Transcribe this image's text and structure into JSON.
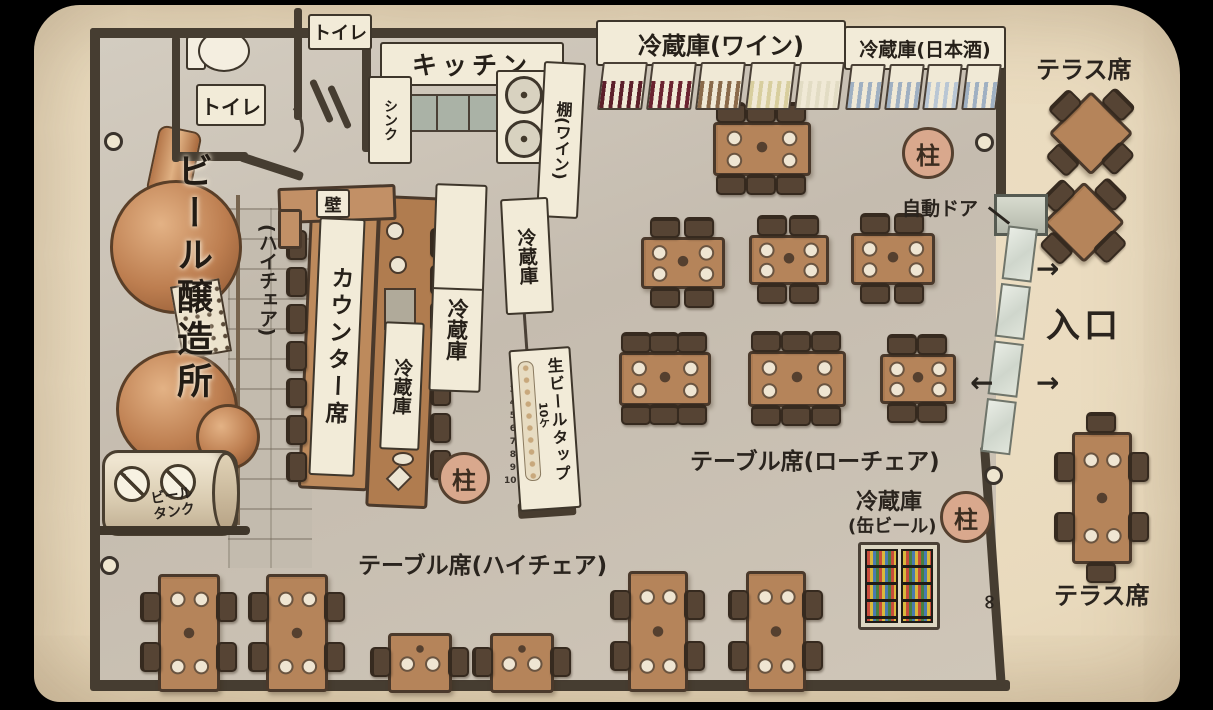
{
  "rooms": {
    "toilet_1": "トイレ",
    "toilet_2": "トイレ",
    "kitchen": "キッチン",
    "sink": "シンク",
    "wine_shelf": "棚(ワイン)",
    "wall": "壁"
  },
  "fridges": {
    "wine": {
      "label": "冷蔵庫(ワイン)",
      "compartments": 5,
      "bottle_colors": [
        "#5d1f2a",
        "#6b2330",
        "#8a6a4a",
        "#d8ce9e",
        "#e2dcc4"
      ]
    },
    "sake": {
      "label": "冷蔵庫(日本酒)",
      "compartments": 4,
      "bottle_colors": [
        "#9fb0c2",
        "#9fb0c2",
        "#b9c6d4",
        "#9fb0c2"
      ]
    },
    "standing_1": "冷蔵庫",
    "standing_2": "冷蔵庫",
    "counter": "冷蔵庫",
    "can_beer": {
      "line1": "冷蔵庫",
      "line2": "(缶ビール)"
    }
  },
  "brewery": {
    "name": "ビール醸造所",
    "tank": "ビール\nタンク"
  },
  "beer_tap": {
    "label": "生ビールタップ",
    "count": "10ケ",
    "numbers": "1\n2\n3\n4\n5\n6\n7\n8\n9\n10"
  },
  "seating": {
    "counter": "カウンター席",
    "counter_note": "(ハイチェア)",
    "table_low": "テーブル席(ローチェア)",
    "table_high": "テーブル席(ハイチェア)",
    "terrace_top": "テラス席",
    "terrace_bottom": "テラス席"
  },
  "entrance": {
    "auto_door": "自動ドア",
    "label": "入口",
    "arrow_in_top": "→",
    "arrow_out": "←",
    "arrow_in_bottom": "→"
  },
  "pillars": {
    "label": "柱",
    "count": 3
  },
  "furniture": {
    "tables": [
      {
        "type": "h6",
        "x": 713,
        "y": 122,
        "w": 92,
        "h": 48
      },
      {
        "type": "h4",
        "x": 641,
        "y": 237,
        "w": 78,
        "h": 46
      },
      {
        "type": "h4",
        "x": 749,
        "y": 235,
        "w": 74,
        "h": 44
      },
      {
        "type": "h4",
        "x": 851,
        "y": 233,
        "w": 78,
        "h": 46
      },
      {
        "type": "h6",
        "x": 619,
        "y": 352,
        "w": 86,
        "h": 48
      },
      {
        "type": "h6",
        "x": 748,
        "y": 351,
        "w": 92,
        "h": 50
      },
      {
        "type": "h4",
        "x": 880,
        "y": 354,
        "w": 70,
        "h": 44
      },
      {
        "type": "v4",
        "x": 158,
        "y": 574,
        "w": 56,
        "h": 112
      },
      {
        "type": "v4",
        "x": 266,
        "y": 574,
        "w": 56,
        "h": 112
      },
      {
        "type": "s2",
        "x": 388,
        "y": 633,
        "w": 58,
        "h": 54
      },
      {
        "type": "s2",
        "x": 490,
        "y": 633,
        "w": 58,
        "h": 54
      },
      {
        "type": "v4",
        "x": 628,
        "y": 571,
        "w": 54,
        "h": 115
      },
      {
        "type": "v4",
        "x": 746,
        "y": 571,
        "w": 54,
        "h": 115
      },
      {
        "type": "d4",
        "x": 1064,
        "y": 102,
        "w": 54,
        "h": 54
      },
      {
        "type": "d4",
        "x": 1058,
        "y": 192,
        "w": 52,
        "h": 52
      },
      {
        "type": "v6",
        "x": 1072,
        "y": 432,
        "w": 54,
        "h": 126
      }
    ],
    "counter_chair_columns": [
      {
        "x": 286,
        "y": 230,
        "count": 7,
        "gap": 37
      },
      {
        "x": 430,
        "y": 228,
        "count": 7,
        "gap": 37
      }
    ]
  }
}
